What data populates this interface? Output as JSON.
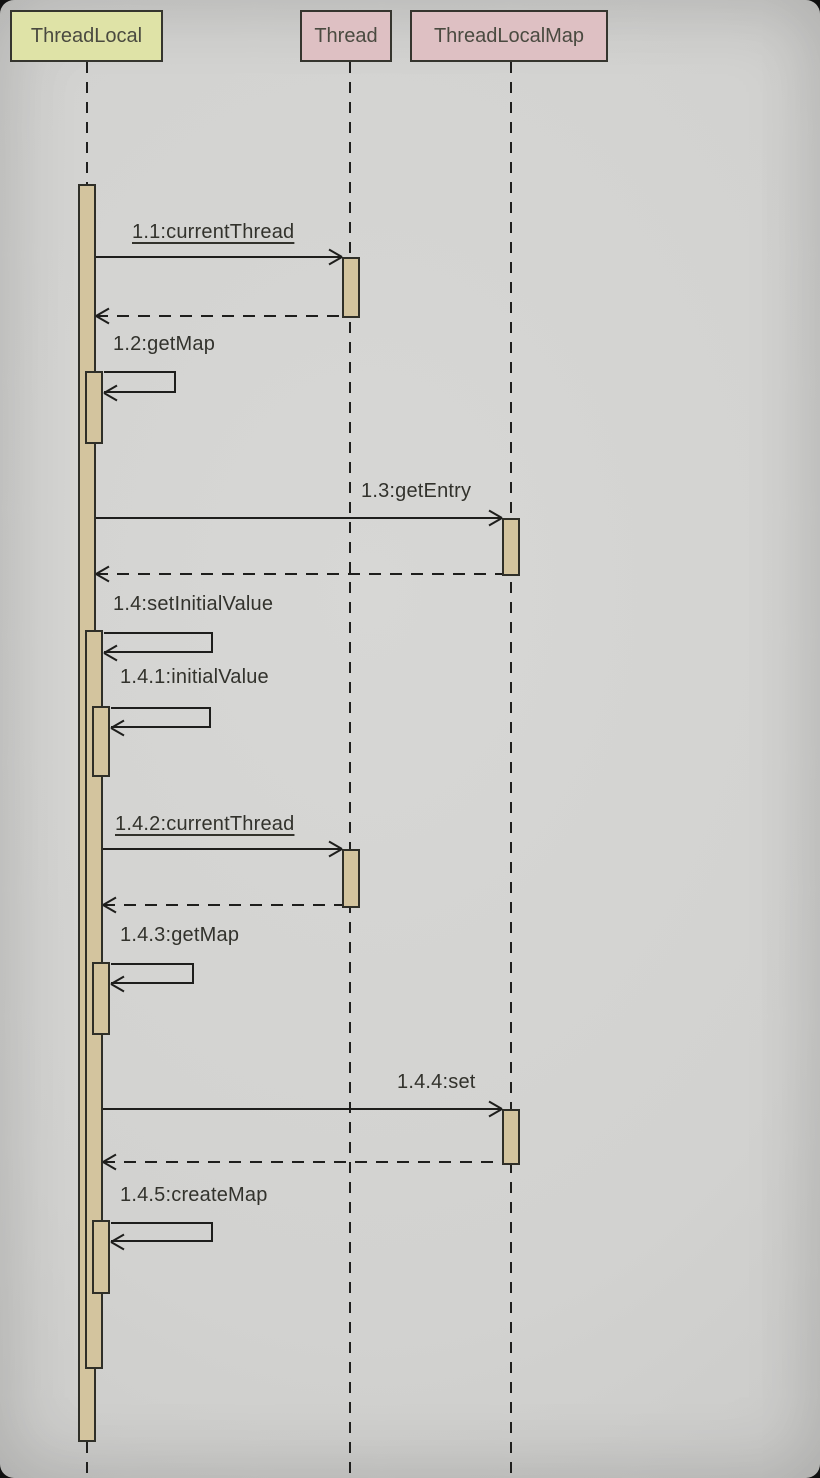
{
  "diagram": {
    "type": "uml-sequence-diagram",
    "participants": [
      {
        "name": "ThreadLocal",
        "fill": "#dfe3a7"
      },
      {
        "name": "Thread",
        "fill": "#dec0c3"
      },
      {
        "name": "ThreadLocalMap",
        "fill": "#dec0c3"
      }
    ],
    "colors": {
      "background": "#d2d2d0",
      "activation_fill": "#d3c49e",
      "line": "#1e1e1c",
      "participant_border": "#35352e"
    },
    "messages": [
      {
        "id": "1.1",
        "label": "1.1:currentThread",
        "from": "ThreadLocal",
        "to": "Thread",
        "type": "call",
        "static_method": true,
        "has_return": true
      },
      {
        "id": "1.2",
        "label": "1.2:getMap",
        "from": "ThreadLocal",
        "to": "ThreadLocal",
        "type": "self-call",
        "static_method": false,
        "has_return": false
      },
      {
        "id": "1.3",
        "label": "1.3:getEntry",
        "from": "ThreadLocal",
        "to": "ThreadLocalMap",
        "type": "call",
        "static_method": false,
        "has_return": true
      },
      {
        "id": "1.4",
        "label": "1.4:setInitialValue",
        "from": "ThreadLocal",
        "to": "ThreadLocal",
        "type": "self-call",
        "static_method": false,
        "has_return": false
      },
      {
        "id": "1.4.1",
        "label": "1.4.1:initialValue",
        "from": "ThreadLocal",
        "to": "ThreadLocal",
        "type": "self-call",
        "static_method": false,
        "has_return": false
      },
      {
        "id": "1.4.2",
        "label": "1.4.2:currentThread",
        "from": "ThreadLocal",
        "to": "Thread",
        "type": "call",
        "static_method": true,
        "has_return": true
      },
      {
        "id": "1.4.3",
        "label": "1.4.3:getMap",
        "from": "ThreadLocal",
        "to": "ThreadLocal",
        "type": "self-call",
        "static_method": false,
        "has_return": false
      },
      {
        "id": "1.4.4",
        "label": "1.4.4:set",
        "from": "ThreadLocal",
        "to": "ThreadLocalMap",
        "type": "call",
        "static_method": false,
        "has_return": true
      },
      {
        "id": "1.4.5",
        "label": "1.4.5:createMap",
        "from": "ThreadLocal",
        "to": "ThreadLocal",
        "type": "self-call",
        "static_method": false,
        "has_return": false
      }
    ]
  }
}
